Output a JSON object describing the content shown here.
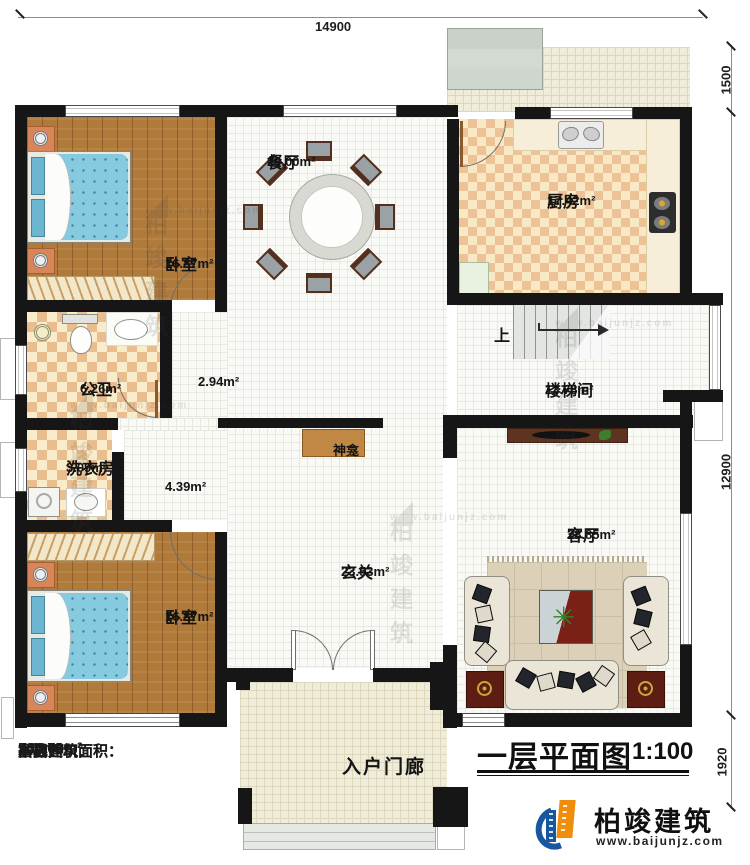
{
  "title_block": {
    "title": "一层平面图",
    "scale": "1:100"
  },
  "brand": {
    "name": "柏竣建筑",
    "url": "www.baijunjz.com"
  },
  "watermark": {
    "name": "柏竣建筑",
    "url": "www.baijunjz.com"
  },
  "dimensions": {
    "top": "14900",
    "right_upper": "1500",
    "right_middle": "12900",
    "right_lower": "1920"
  },
  "stats": [
    {
      "label": "本层建筑面积：",
      "value": "188.72m²"
    },
    {
      "label": "本栋建筑面积：",
      "value": "544.69m²"
    },
    {
      "label": "占地面积：",
      "value": "234.08m²"
    },
    {
      "label": "层高：",
      "value": "3.6m"
    }
  ],
  "rooms": {
    "bedroom_top": {
      "name": "卧室",
      "area": "16.87m²"
    },
    "dining": {
      "name": "餐厅",
      "area": "29.00m²"
    },
    "kitchen": {
      "name": "厨房",
      "area": "17.42m²"
    },
    "bathroom": {
      "name": "公卫",
      "area": "6.26m²"
    },
    "hall_upper": {
      "area": "2.94m²"
    },
    "laundry": {
      "name": "洗衣房",
      "area": "3.09m²"
    },
    "hall_lower": {
      "area": "4.39m²"
    },
    "stairwell": {
      "name": "楼梯间",
      "area": "13.78m²"
    },
    "shrine": {
      "name": "神龛"
    },
    "foyer": {
      "name": "玄关",
      "area": "23.53m²"
    },
    "living": {
      "name": "客厅",
      "area": "28.85m²"
    },
    "bedroom_bottom": {
      "name": "卧室",
      "area": "16.87m²"
    },
    "porch": {
      "name": "入户门廊"
    },
    "stair_up": {
      "label": "上"
    }
  },
  "colors": {
    "wall": "#161616",
    "wood_floor": "#b07a3b",
    "tile": "#f9f9f6",
    "kitchen_checker": "#ecc296",
    "terrace": "#efecda",
    "shrine_wood": "#c18845",
    "bed_blue": "#85cade",
    "table_red": "#7a2017",
    "brand_blue": "#1757a0",
    "brand_orange": "#ef8e0d"
  }
}
